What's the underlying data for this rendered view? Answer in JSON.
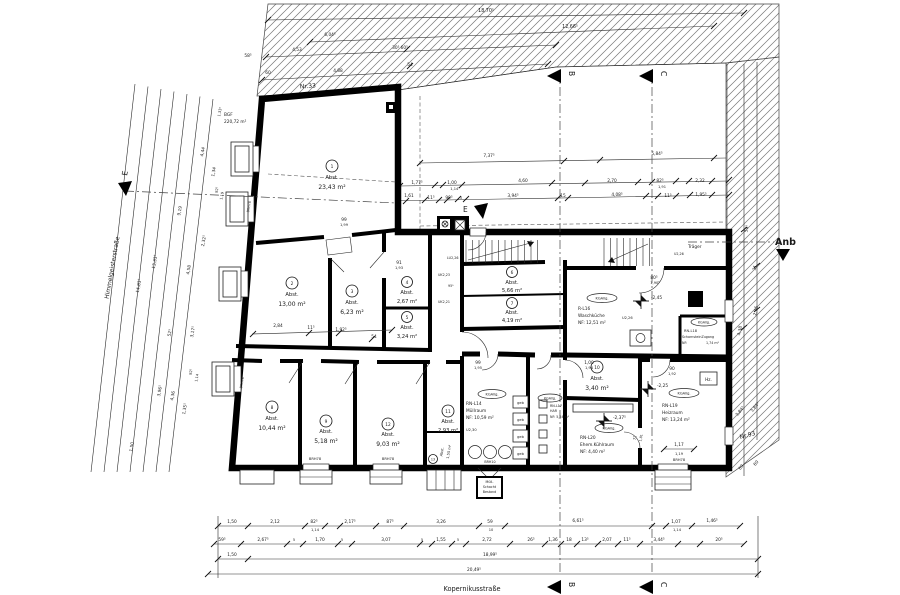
{
  "streets": {
    "left": "Himmelgeisterstraße",
    "bottom": "Kopernikusstraße"
  },
  "site": {
    "nr33": "Nr.33",
    "nr93": "Nr.93",
    "anb": "Anb",
    "bgf1": "BGF",
    "bgf2": "220,72 m²",
    "traeger": "Träger"
  },
  "sections": {
    "b": "B",
    "c": "C",
    "e": "E"
  },
  "rooms": [
    {
      "n": "1",
      "t": "Abst.",
      "a": "23,43 m²"
    },
    {
      "n": "2",
      "t": "Abst.",
      "a": "13,00 m²"
    },
    {
      "n": "3",
      "t": "Abst.",
      "a": "6,23 m²"
    },
    {
      "n": "4",
      "t": "Abst.",
      "a": "2,67 m²"
    },
    {
      "n": "5",
      "t": "Abst.",
      "a": "3,24 m²"
    },
    {
      "n": "6",
      "t": "Abst.",
      "a": "5,66 m²"
    },
    {
      "n": "7",
      "t": "Abst.",
      "a": "4,19 m²"
    },
    {
      "n": "8",
      "t": "Abst.",
      "a": "10,44 m²"
    },
    {
      "n": "9",
      "t": "Abst.",
      "a": "5,18 m²"
    },
    {
      "n": "10",
      "t": "Abst.",
      "a": "3,40 m²"
    },
    {
      "n": "11",
      "t": "Abst.",
      "a": "2,93 m²"
    },
    {
      "n": "12",
      "t": "Abst.",
      "a": "9,03 m²"
    },
    {
      "n": "13",
      "t": "Abst.",
      "a": "1,55 m²"
    }
  ],
  "named": {
    "waschkueche": {
      "id": "R-L16",
      "name": "Waschküche",
      "nf": "NF: 12,51 m²"
    },
    "schornstein": {
      "id": "RN-L18",
      "name": "SchornsteinZugang",
      "nf1": "NF:",
      "nf2": "1,74 m²"
    },
    "heizraum": {
      "id": "RN-L19",
      "name": "Heizraum",
      "nf": "NF: 13,24 m²"
    },
    "kuehlraum": {
      "id": "RN-L20",
      "name": "Ehem.Kühlraum",
      "nf": "NF:  4,40 m²"
    },
    "muellraum": {
      "id": "RN-L14",
      "name": "Müllraum",
      "nf": "NF: 10,59 m²"
    },
    "har": {
      "id": "RN-L17",
      "name": "HAR",
      "nf": "NF: 5,24 m²"
    }
  },
  "labels": {
    "kg": "KGAllg.",
    "geb": "geb",
    "brh78": "BRH78",
    "brh10": "BRH10",
    "hz": "Hz.",
    "u226": "U2,26",
    "lu226": "LU2,26",
    "uk223": "UK2,23",
    "uk221": "UK2,21",
    "u230": "U2,30",
    "m245": "-2,45",
    "m225": "-2,25",
    "m2375": "-2,37⁵",
    "ms1": "Müll-",
    "ms2": "Schacht",
    "ms3": "Bestand"
  },
  "dims": {
    "top": [
      "18,70⁵",
      "12,66⁵",
      "6,04⁵",
      "4,53",
      "58⁵",
      "30⁵  60⁵",
      "60",
      "4,88",
      "54"
    ],
    "upper": [
      "7,37⁵",
      "5,84⁵",
      "1,77⁵",
      "1,00",
      "1,14⁵",
      "4,60",
      "2,70",
      "82⁵",
      "1,91",
      "2,32",
      "11⁵",
      "99⁵",
      "5",
      "3,94⁵",
      "15",
      "4,08⁵",
      "11⁵",
      "1,95⁵"
    ],
    "left": [
      "14,83⁵",
      "13,33⁵",
      "9,19",
      "4,58",
      "4,44",
      "1,34",
      "2,32⁵",
      "82⁵",
      "1,19",
      "3,17⁵",
      "52⁵",
      "82⁵",
      "1,14",
      "3,96⁵",
      "4,36",
      "1,35⁵",
      "1,50",
      "1,33⁵"
    ],
    "right": [
      "54⁵",
      "31",
      "4,38",
      "2,36",
      "3,84⁵",
      "3,84⁵",
      "60",
      "60"
    ],
    "inner": [
      "99",
      "1,99",
      "91",
      "1,93",
      "2,84",
      "11⁵",
      "1,92⁵",
      "54",
      "54⁵",
      "1,61",
      "80⁵",
      "1,90⁵",
      "90",
      "1,92",
      "99",
      "1,95",
      "1,00",
      "1,94",
      "1,17",
      "1,19",
      "72",
      "1,81",
      "95⁵"
    ],
    "bottom1": [
      "1,50",
      "2,12",
      "82⁵",
      "1,14",
      "2,17⁵",
      "87⁵",
      "3,26",
      "59",
      "10",
      "6,61⁵",
      "1,07",
      "1,14",
      "1,46⁵"
    ],
    "bottom2": [
      "59⁵",
      "2,67⁵",
      "5",
      "1,70",
      "5",
      "3,07",
      "5",
      "1,55",
      "5",
      "2,72",
      "26⁵",
      "1,36",
      "18",
      "13⁵",
      "2,07",
      "11⁵",
      "3,44⁵",
      "20⁵"
    ],
    "bottom3": [
      "1,50",
      "18,99⁵"
    ],
    "bottom4": [
      "20,49⁵"
    ]
  }
}
